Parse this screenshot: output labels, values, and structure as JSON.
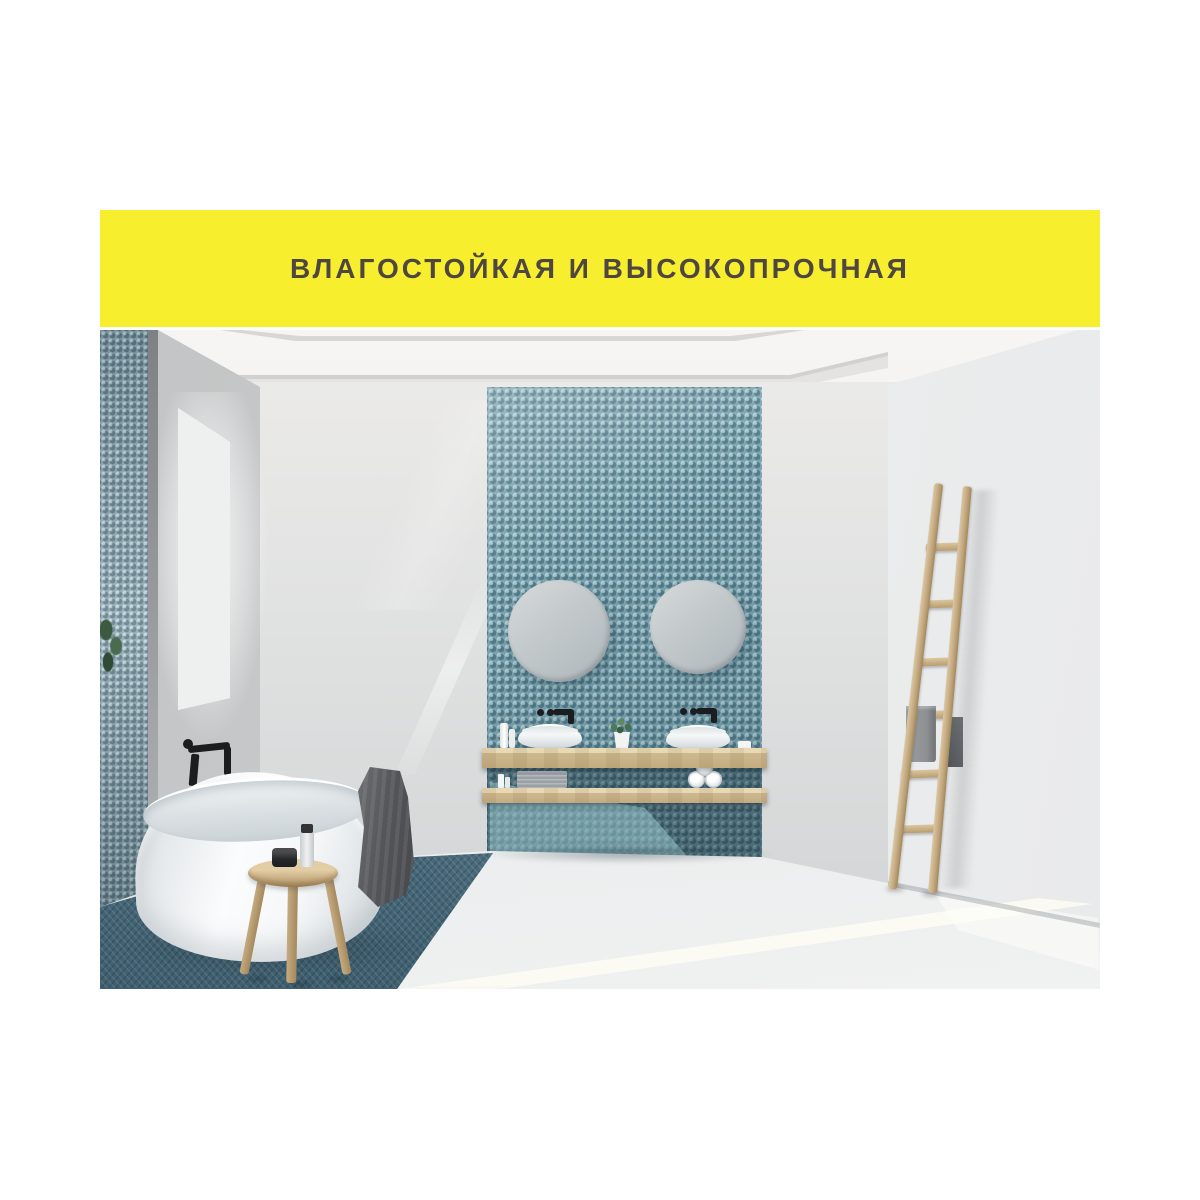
{
  "banner": {
    "label": "ВЛАГОСТОЙКАЯ И ВЫСОКОПРОЧНАЯ"
  },
  "scene": {
    "subject": "bathroom-interior-photo",
    "objects": [
      "mosaic-accent-wall",
      "round-mirrors",
      "vessel-sinks",
      "wood-shelves",
      "freestanding-bathtub",
      "wood-stool",
      "decor-ladder",
      "window",
      "towels"
    ]
  },
  "colors": {
    "banner_bg": "#f7ee2e",
    "banner_text": "#4e4741",
    "ceiling": "#f2f1ef",
    "wall_back": "#e3e4e4",
    "wall_window": "#c8cacb",
    "wall_right": "#e9eaeb",
    "mosaic_teal": "#7ca4b0",
    "mosaic_wall_left": "#8ca7b2",
    "mosaic_floor": "#567b8e",
    "floor_white": "#e6e8e9",
    "wood": "#c9b289",
    "fixture_white": "#fafbfb",
    "fixture_black": "#1c1d1e",
    "towel_dark": "#55565a",
    "towel_light": "#8d9092",
    "plant_green": "#3f5c44"
  }
}
